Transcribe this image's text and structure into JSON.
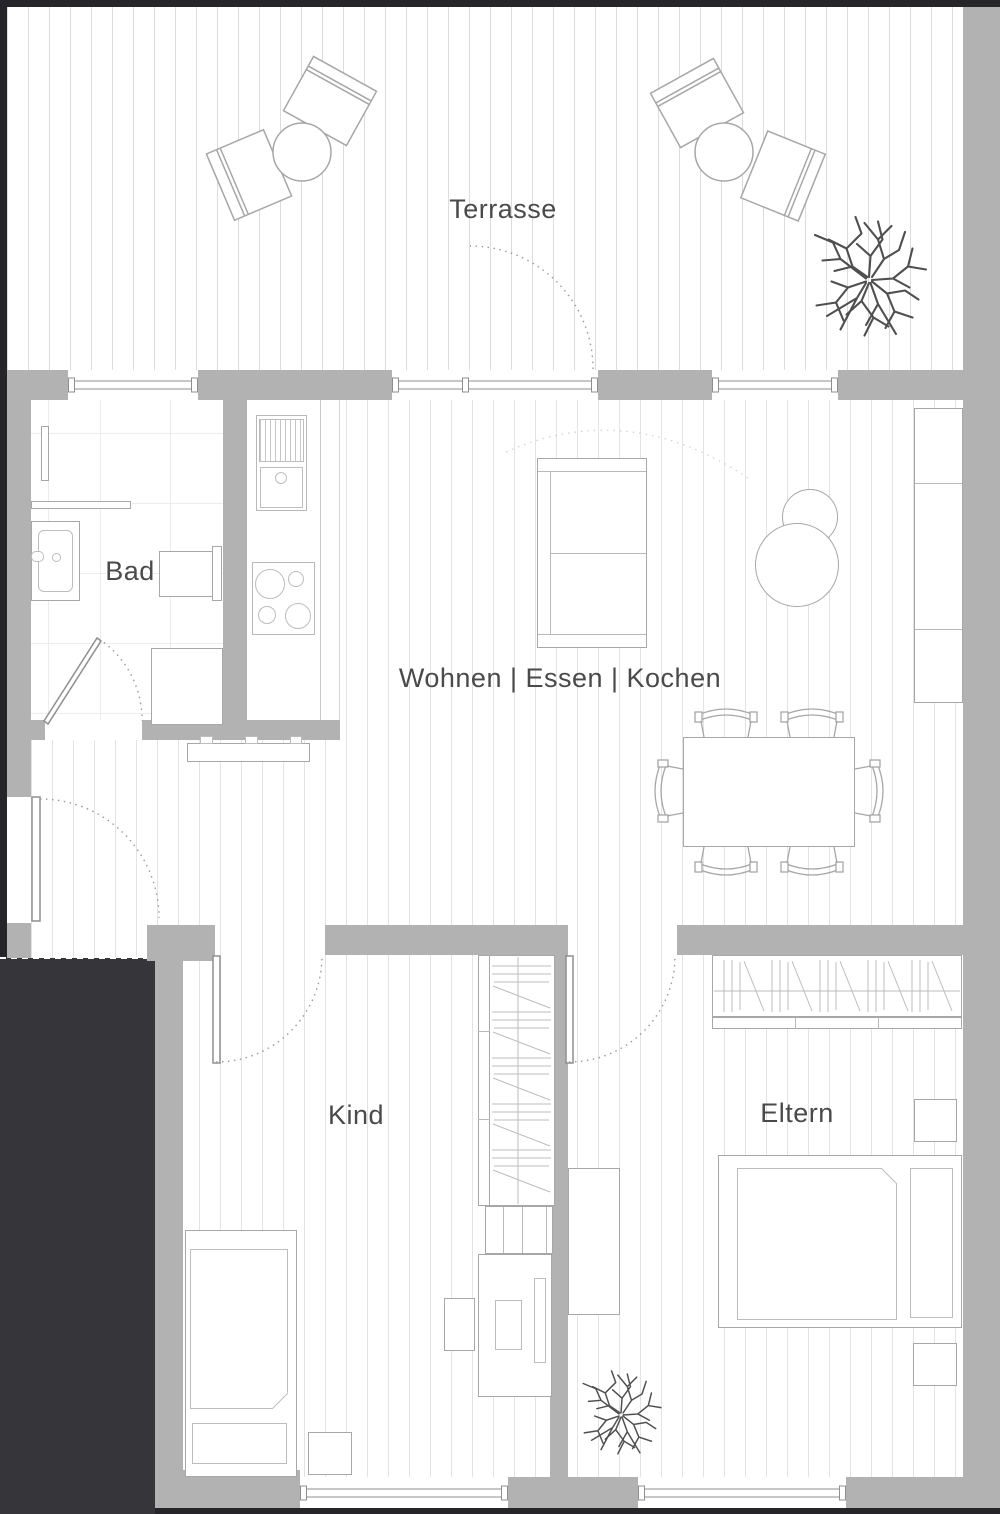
{
  "labels": {
    "terrace": "Terrasse",
    "living": "Wohnen | Essen | Kochen",
    "bath": "Bad",
    "child": "Kind",
    "parents": "Eltern"
  },
  "rooms": [
    "Terrasse",
    "Wohnen | Essen | Kochen",
    "Bad",
    "Kind",
    "Eltern"
  ],
  "colors": {
    "wall": "#b2b2b2",
    "void_area": "#35353a",
    "furniture_outline": "#a7a7a7",
    "floor_line": "#e3e3e3",
    "boundary_line": "#26262a",
    "label_text": "#4a4a4a"
  }
}
